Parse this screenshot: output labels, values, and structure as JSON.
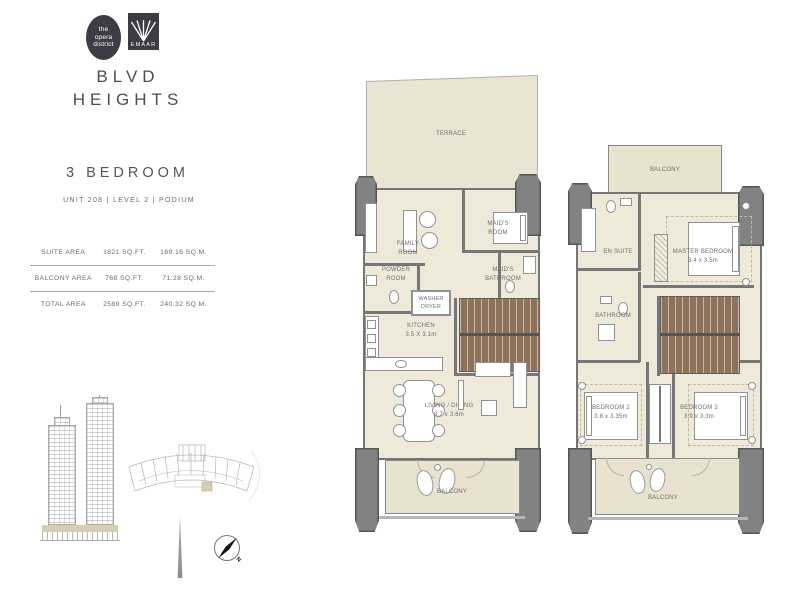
{
  "brand": {
    "opera_logo": {
      "line1": "the",
      "line2": "opera",
      "line3": "district"
    },
    "emaar_logo": {
      "label": "EMAAR"
    },
    "project_title_line1": "BLVD",
    "project_title_line2": "HEIGHTS"
  },
  "unit_header": {
    "bedrooms": "3 BEDROOM",
    "unit_info": "UNIT 208 | LEVEL 2  | PODIUM"
  },
  "area_table": {
    "rows": [
      {
        "label": "SUITE AREA",
        "sqft": "1821 SQ.FT.",
        "sqm": "169.16 SQ.M."
      },
      {
        "label": "BALCONY AREA",
        "sqft": "768 SQ.FT.",
        "sqm": "71.28 SQ.M."
      },
      {
        "label": "TOTAL AREA",
        "sqft": "2589 SQ.FT.",
        "sqm": "240.32 SQ.M."
      }
    ]
  },
  "plan_level1": {
    "terrace": "TERRACE",
    "family_room": "FAMILY\nROOM",
    "maids_room": "MAID'S\nROOM",
    "maids_bathroom": "MAID'S\nBATHROOM",
    "powder_room": "POWDER\nROOM",
    "washer_dryer": "WASHER\nDRYER",
    "kitchen": "KITCHEN\n3.5 X 3.1m",
    "living_dining": "LIVING / DINING\n8.7 x 3.6m",
    "balcony": "BALCONY"
  },
  "plan_level2": {
    "balcony_top": "BALCONY",
    "en_suite": "EN SUITE",
    "master_bedroom": "MASTER BEDROOM\n3.4 x 3.5m",
    "bathroom": "BATHROOM",
    "bedroom_2": "BEDROOM 2\n3.8 x 3.35m",
    "bedroom_3": "BEDROOM 3\n3.9 x 3.3m",
    "balcony_bottom": "BALCONY"
  },
  "compass": {
    "north": "N"
  },
  "colors": {
    "floor": "#efe9d9",
    "terrace": "#ebe4d2",
    "wall": "#757575",
    "stairs": "#8d7158",
    "brand_dark": "#3c3c44",
    "highlight_beige": "#d6cdb2"
  }
}
